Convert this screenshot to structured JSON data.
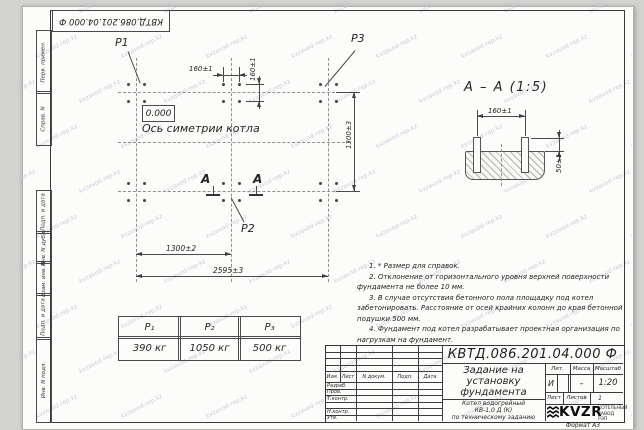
{
  "watermark": {
    "text": "kvzavod-rep.kz"
  },
  "stamp": {
    "doc_number": "КВТД.086.201.04.000 Ф"
  },
  "margin_fields": [
    "Перв. примен.",
    "Справ. N",
    "Подп. и дата",
    "Инв. N дубл.",
    "Взам. инв. N",
    "Подп. и дата",
    "Инв. N подл."
  ],
  "plan": {
    "load_labels": {
      "p1": "P1",
      "p2": "P2",
      "p3": "P3"
    },
    "level_mark": "0.000",
    "axis_label": "Ось симетрии котла",
    "section_letter": "А",
    "dims": {
      "bolt_spacing_h": "160±1",
      "bolt_spacing_v": "160±1",
      "span_left": "1300±2",
      "span_total": "2595±3",
      "span_vertical": "1300±3"
    }
  },
  "section_view": {
    "title": "А – А (1:5)",
    "dims": {
      "bolt_spacing": "160±1",
      "protrusion": "50±1"
    }
  },
  "loads_table": {
    "headers": [
      "P₁",
      "P₂",
      "P₃"
    ],
    "values": [
      "390 кг",
      "1050 кг",
      "500 кг"
    ]
  },
  "notes": [
    "1. * Размер для справок.",
    "2. Отклонение от горизонтального уровня верхней поверхности фундамента не более 10 мм.",
    "3. В случае отсутствия бетонного пола площадку под котел забетонировать. Расстояние от осей крайних колонн до края бетонной подушки 500 мм.",
    "4. Фундамент под котел разрабатывает проектная организация по нагрузкам на фундамент."
  ],
  "title_block": {
    "doc_number": "КВТД.086.201.04.000  Ф",
    "title_lines": [
      "Задание на",
      "установку",
      "фундамента"
    ],
    "product_lines": [
      "Котел водогрейный",
      "КВ-1,0 Д (К)",
      "по техническому заданию"
    ],
    "header_cols": [
      "Изм.",
      "Лист",
      "N докум.",
      "Подп.",
      "Дата"
    ],
    "roles": [
      "Разраб.",
      "Пров.",
      "Т.контр.",
      "",
      "Н.контр.",
      "Утв."
    ],
    "lit_label": "Лит.",
    "mass_label": "Масса",
    "scale_label": "Масштаб",
    "lit_value": "И",
    "mass_value": "–",
    "scale_value": "1:20",
    "sheet_label": "Лист",
    "sheets_label": "Листов",
    "sheets_value": "1",
    "logo_text": "KVZR",
    "company_lines": [
      "КОТЕЛЬНЫЙ",
      "ЗАВОД РЭП"
    ],
    "format_label": "Формат А3"
  }
}
